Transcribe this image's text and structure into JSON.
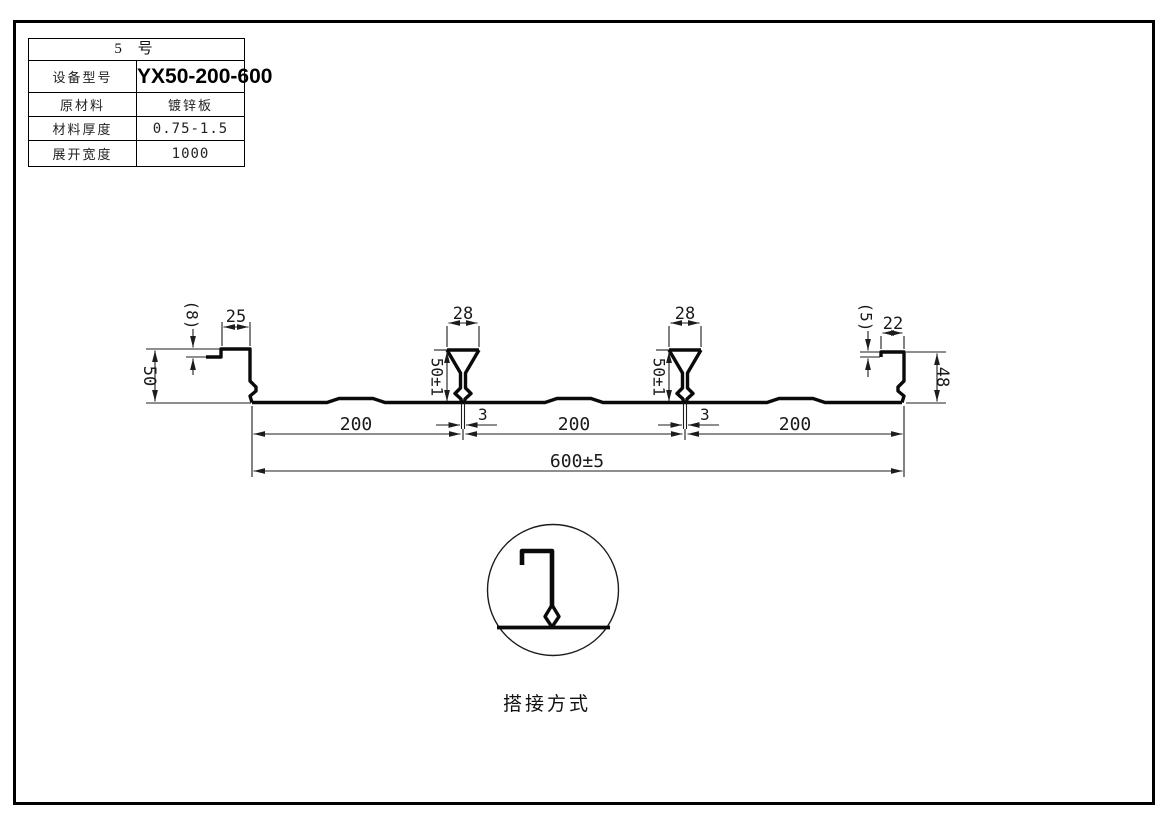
{
  "spec_table": {
    "title": "5  号",
    "rows": [
      {
        "label": "设备型号",
        "value": "YX50-200-600"
      },
      {
        "label": "原材料",
        "value": "镀锌板"
      },
      {
        "label": "材料厚度",
        "value": "0.75-1.5"
      },
      {
        "label": "展开宽度",
        "value": "1000"
      }
    ]
  },
  "dimensions": {
    "left_edge_drop": "(8)",
    "left_flange_width": "25",
    "left_height": "50",
    "rib_top_width": "28",
    "rib_height": "50±1",
    "rib_stem_width": "3",
    "right_edge_drop": "(5)",
    "right_flange_width": "22",
    "right_height": "48",
    "pitch": "200",
    "overall_width": "600±5"
  },
  "detail": {
    "caption": "搭接方式"
  },
  "colors": {
    "line": "#0a0a0a",
    "background": "#ffffff"
  }
}
